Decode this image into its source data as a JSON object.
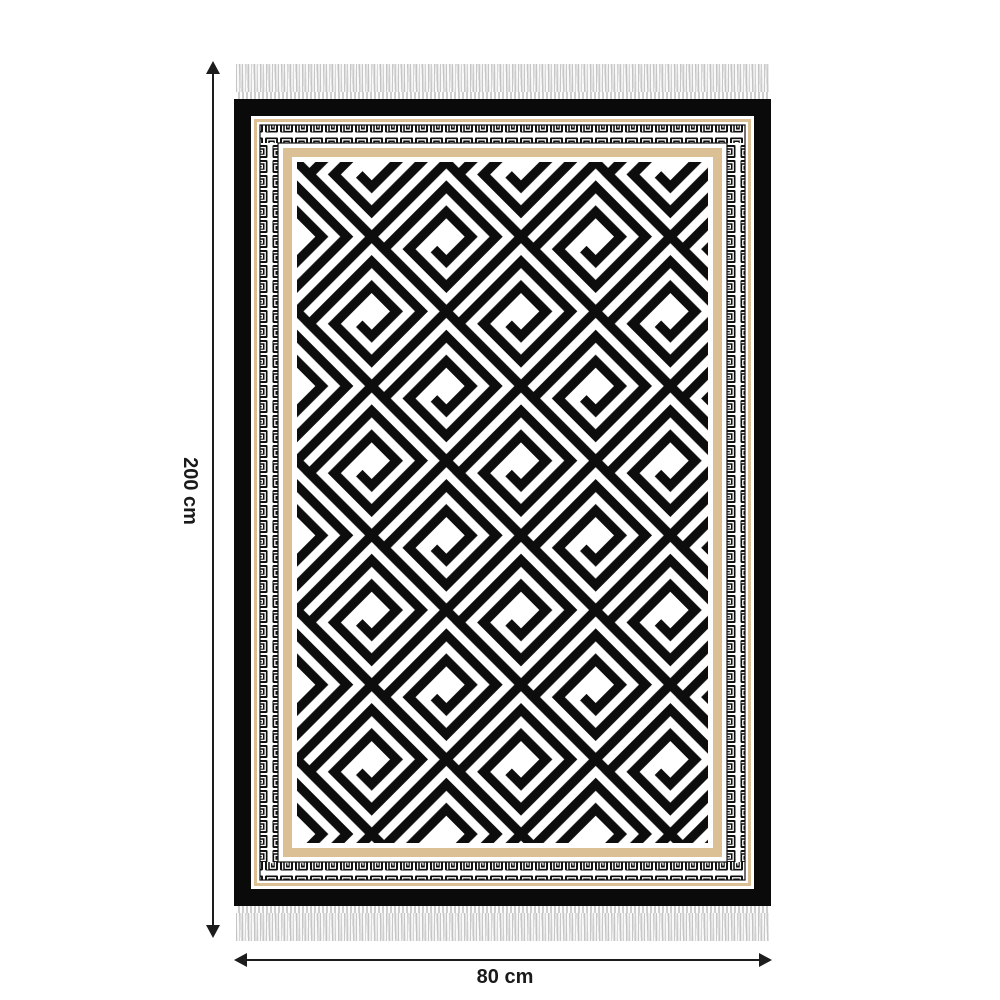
{
  "image": {
    "type": "rug product dimension diagram",
    "height_annotation": "200 cm",
    "width_annotation": "80 cm"
  },
  "rug": {
    "pattern": "greek-key spiral field with meander border",
    "colors": {
      "black": "#0a0a0a",
      "white": "#ffffff",
      "tan_accent": "#dcc095",
      "fringe_gray": "#ececec",
      "arrow": "#1c1c1c"
    },
    "fringe": "tasseled fringe on top and bottom edges"
  }
}
